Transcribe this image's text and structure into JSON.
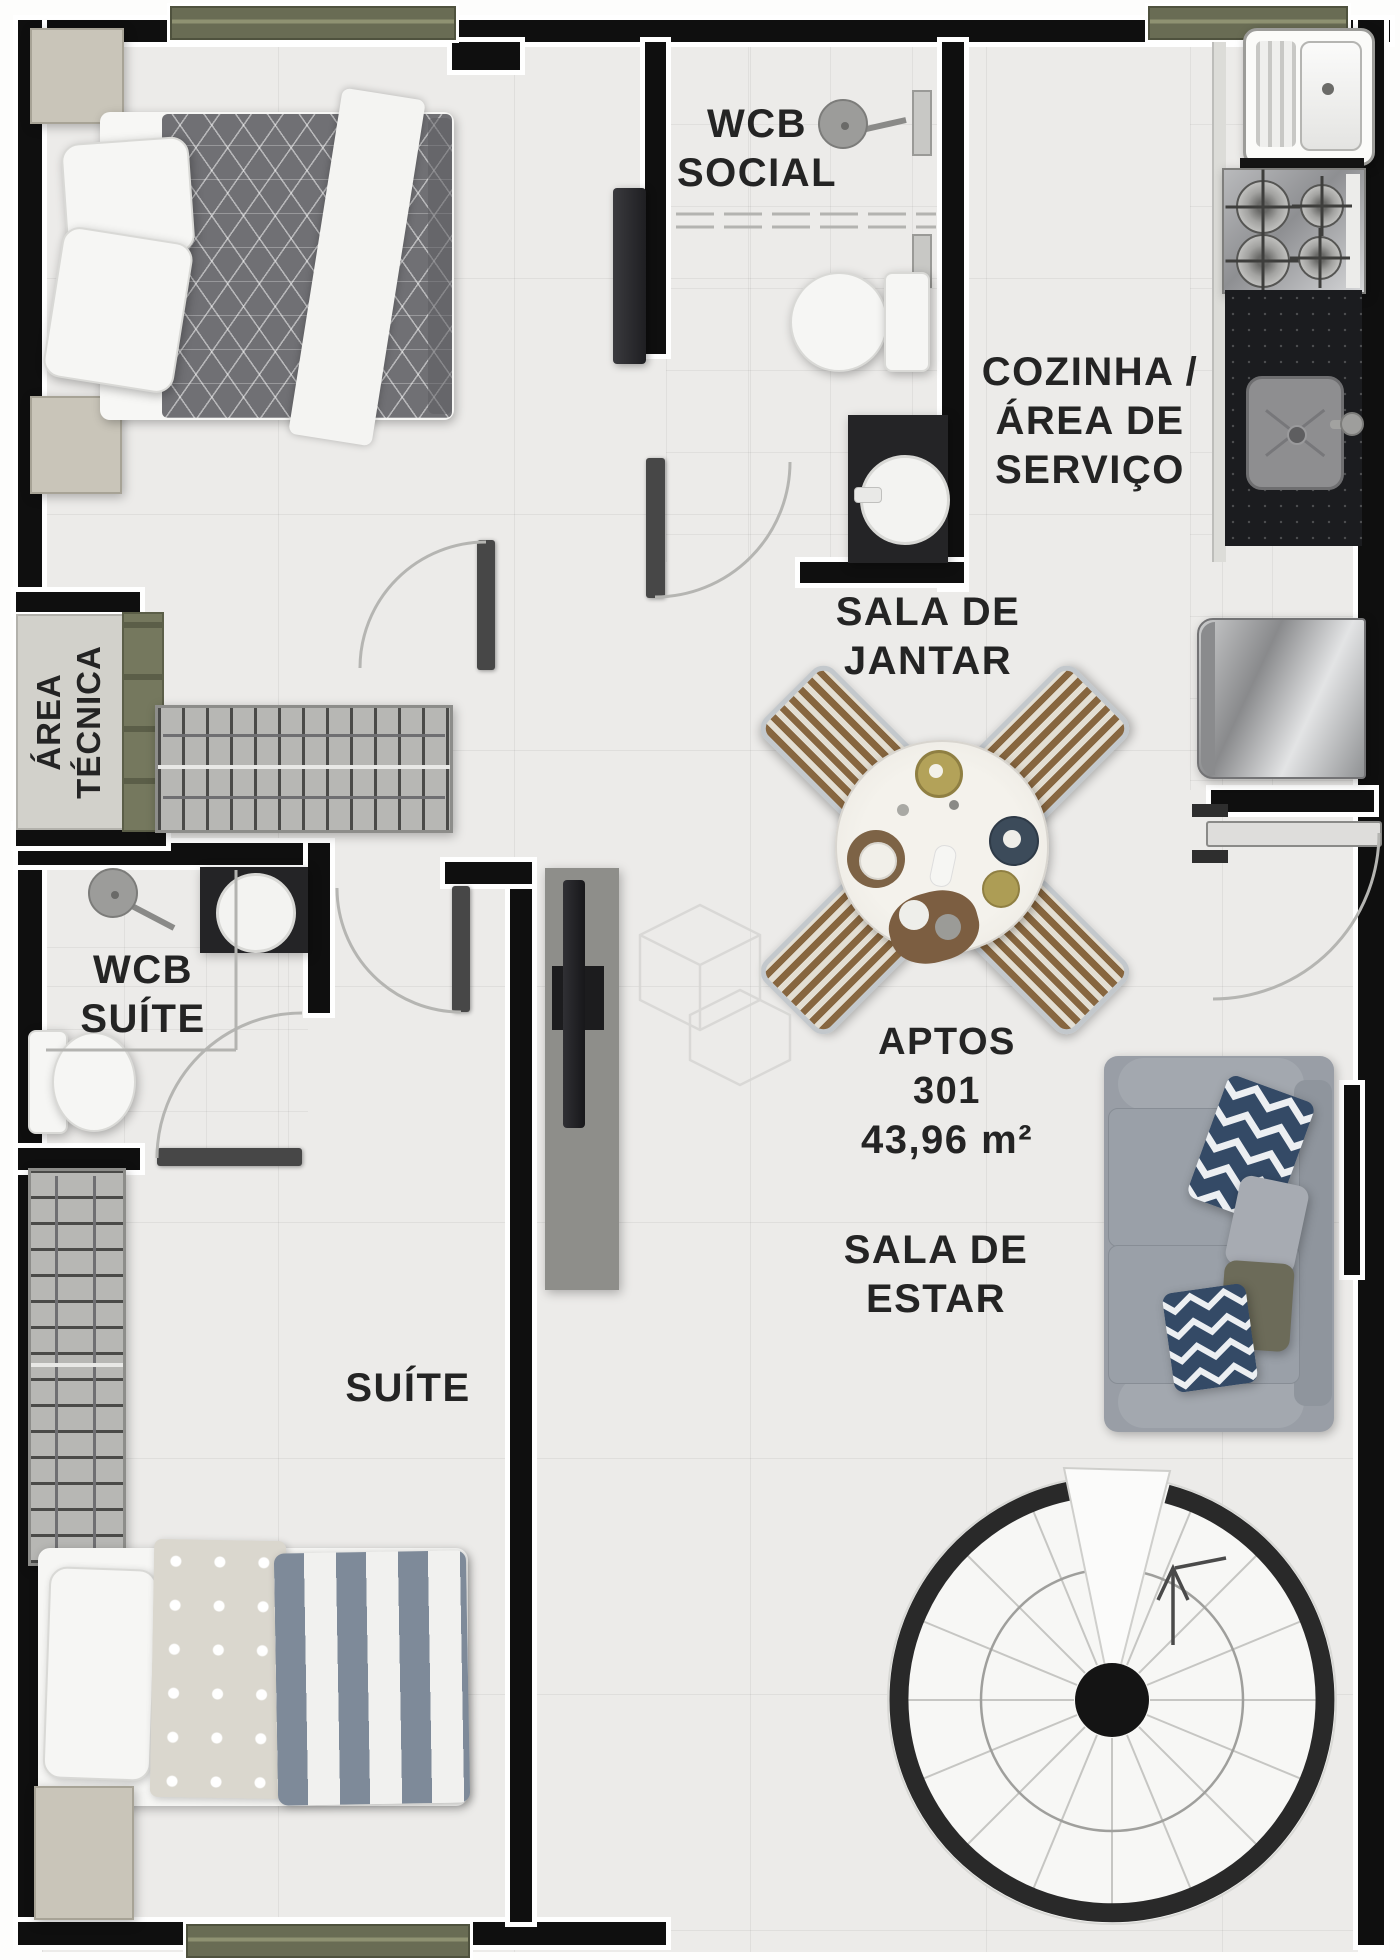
{
  "apartment": {
    "name": "APTOS",
    "number": "301",
    "area": "43,96 m²"
  },
  "rooms": {
    "wcb_social": {
      "lines": [
        "WCB",
        "SOCIAL"
      ]
    },
    "cozinha": {
      "lines": [
        "COZINHA /",
        "ÁREA DE",
        "SERVIÇO"
      ]
    },
    "sala_jantar": {
      "lines": [
        "SALA DE",
        "JANTAR"
      ]
    },
    "sala_estar": {
      "lines": [
        "SALA DE",
        "ESTAR"
      ]
    },
    "wcb_suite": {
      "lines": [
        "WCB",
        "SUÍTE"
      ]
    },
    "suite": {
      "lines": [
        "SUÍTE"
      ]
    },
    "area_tecnica": {
      "lines": [
        "ÁREA",
        "TÉCNICA"
      ]
    }
  },
  "colors": {
    "wall": "#0f0f0f",
    "window_frame": "#696c54",
    "floor": "#ecebe9",
    "label_text": "#242424",
    "sofa_gray": "#9aa0a8",
    "pillow_navy": "#344a66",
    "pillow_olive": "#6c6b59",
    "chair_wood": "#87663f",
    "granite_black": "#1b1c1f",
    "stainless_steel": "#b9babc",
    "nightstand_tan": "#c9c5b9",
    "stair_ring": "#292929"
  }
}
